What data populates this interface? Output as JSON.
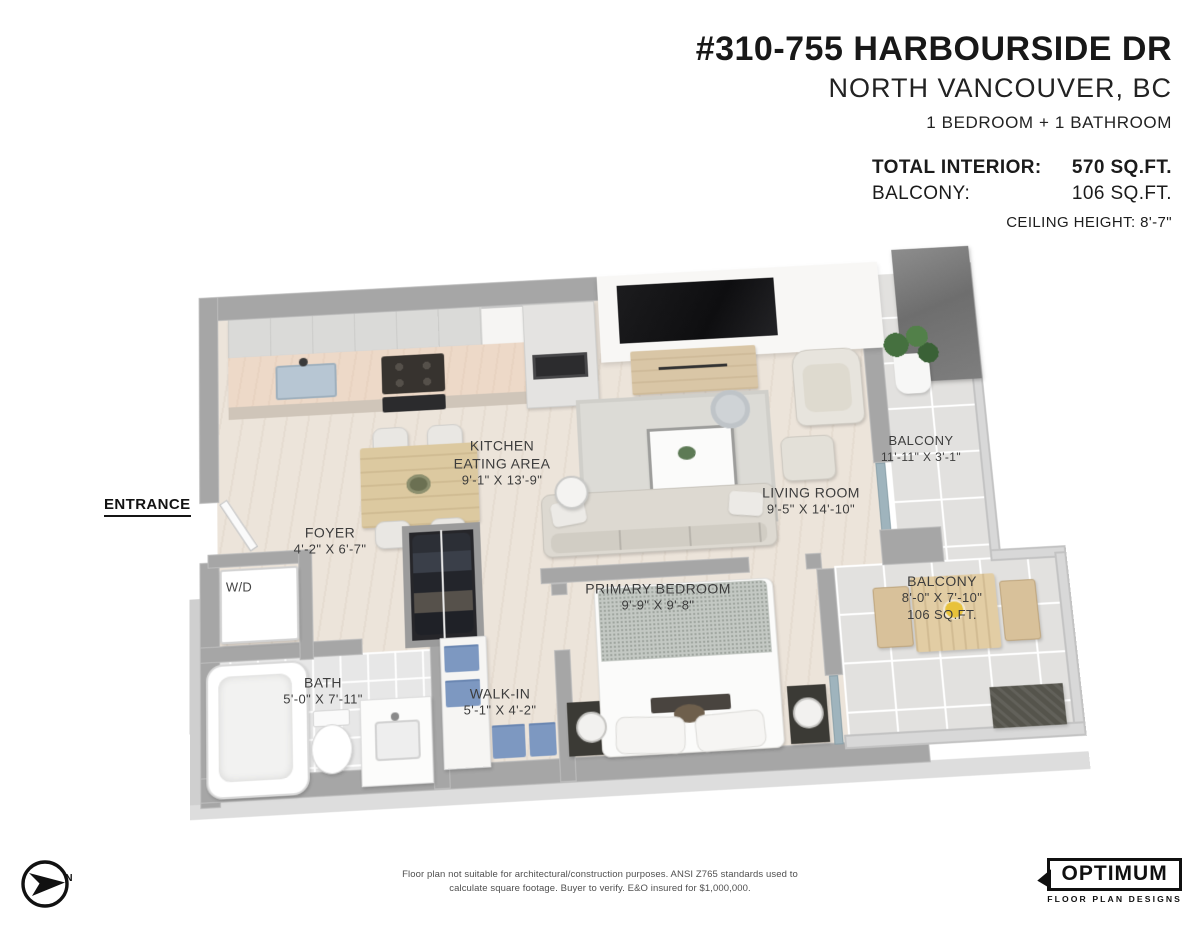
{
  "header": {
    "address_line1": "#310-755 HARBOURSIDE DR",
    "address_line2": "NORTH VANCOUVER, BC",
    "configuration": "1 BEDROOM + 1 BATHROOM",
    "total_interior_label": "TOTAL INTERIOR:",
    "total_interior_value": "570 SQ.FT.",
    "balcony_label": "BALCONY:",
    "balcony_value": "106 SQ.FT.",
    "ceiling_height": "CEILING HEIGHT: 8'-7\""
  },
  "plan": {
    "entrance_label": "ENTRANCE",
    "wd_label": "W/D",
    "rooms": [
      {
        "line1": "KITCHEN",
        "line2": "EATING AREA",
        "dims": "9'-1\" X 13'-9\""
      },
      {
        "line1": "LIVING ROOM",
        "dims": "9'-5\" X 14'-10\""
      },
      {
        "line1": "BALCONY",
        "dims": "11'-11\" X 3'-1\""
      },
      {
        "line1": "FOYER",
        "dims": "4'-2\" X 6'-7\""
      },
      {
        "line1": "PRIMARY BEDROOM",
        "dims": "9'-9\" X 9'-8\""
      },
      {
        "line1": "BALCONY",
        "dims": "8'-0\" X 7'-10\"",
        "area": "106 SQ.FT."
      },
      {
        "line1": "BATH",
        "dims": "5'-0\" X 7'-11\""
      },
      {
        "line1": "WALK-IN",
        "dims": "5'-1\" X 4'-2\""
      }
    ]
  },
  "footer": {
    "compass_label": "N",
    "disclaimer_line1": "Floor plan not suitable for architectural/construction purposes. ANSI Z765 standards used to",
    "disclaimer_line2": "calculate square footage. Buyer to verify. E&O insured for $1,000,000.",
    "logo_name": "OPTIMUM",
    "logo_subtitle": "FLOOR PLAN DESIGNS"
  },
  "colors": {
    "wall_grey": "#a6a6a6",
    "wood_floor": "#ece4da",
    "balcony_tile": "#e2e1df",
    "tv_black": "#141414",
    "linen_blue": "#7d98c1",
    "plant_green": "#45703f",
    "text_dark": "#1b1b1b"
  }
}
